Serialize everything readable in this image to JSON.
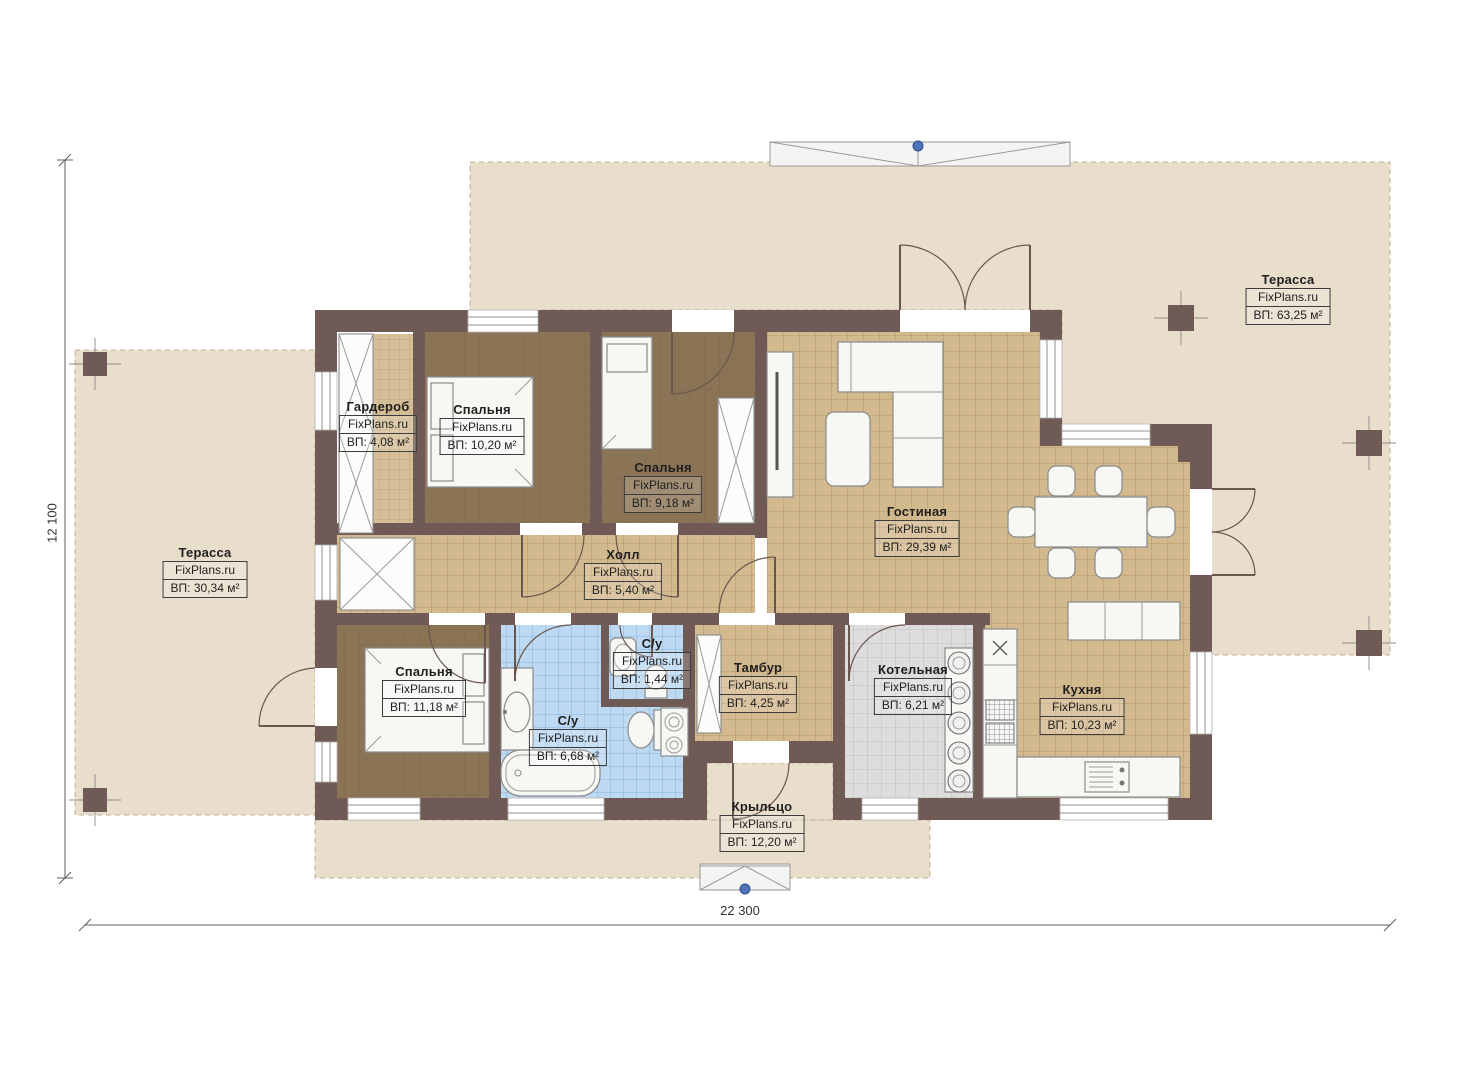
{
  "plan": {
    "watermark": "FixPlans.ru",
    "dim_width": "22 300",
    "dim_height": "12 100"
  },
  "rooms": [
    {
      "id": "terrace-top",
      "name": "Терасса",
      "area": "ВП: 63,25 м²"
    },
    {
      "id": "terrace-left",
      "name": "Терасса",
      "area": "ВП: 30,34 м²"
    },
    {
      "id": "wardrobe",
      "name": "Гардероб",
      "area": "ВП: 4,08 м²"
    },
    {
      "id": "bedroom-1",
      "name": "Спальня",
      "area": "ВП: 10,20 м²"
    },
    {
      "id": "bedroom-2",
      "name": "Спальня",
      "area": "ВП: 9,18 м²"
    },
    {
      "id": "living-room",
      "name": "Гостиная",
      "area": "ВП: 29,39 м²"
    },
    {
      "id": "hall",
      "name": "Холл",
      "area": "ВП: 5,40 м²"
    },
    {
      "id": "bedroom-3",
      "name": "Спальня",
      "area": "ВП: 11,18 м²"
    },
    {
      "id": "bathroom",
      "name": "С/у",
      "area": "ВП: 6,68 м²"
    },
    {
      "id": "wc-small",
      "name": "С/у",
      "area": "ВП: 1,44 м²"
    },
    {
      "id": "vestibule",
      "name": "Тамбур",
      "area": "ВП: 4,25 м²"
    },
    {
      "id": "boiler-room",
      "name": "Котельная",
      "area": "ВП: 6,21 м²"
    },
    {
      "id": "kitchen",
      "name": "Кухня",
      "area": "ВП: 10,23 м²"
    },
    {
      "id": "porch",
      "name": "Крыльцо",
      "area": "ВП: 12,20 м²"
    }
  ],
  "colors": {
    "wall": "#6f5a55",
    "terrace": "#e9ddcc",
    "tile": "#d3b98e",
    "carpet": "#8b7456",
    "bath_tile": "#bed9f2",
    "boiler_tile": "#dddddd",
    "pin_blue": "#5074b8"
  }
}
